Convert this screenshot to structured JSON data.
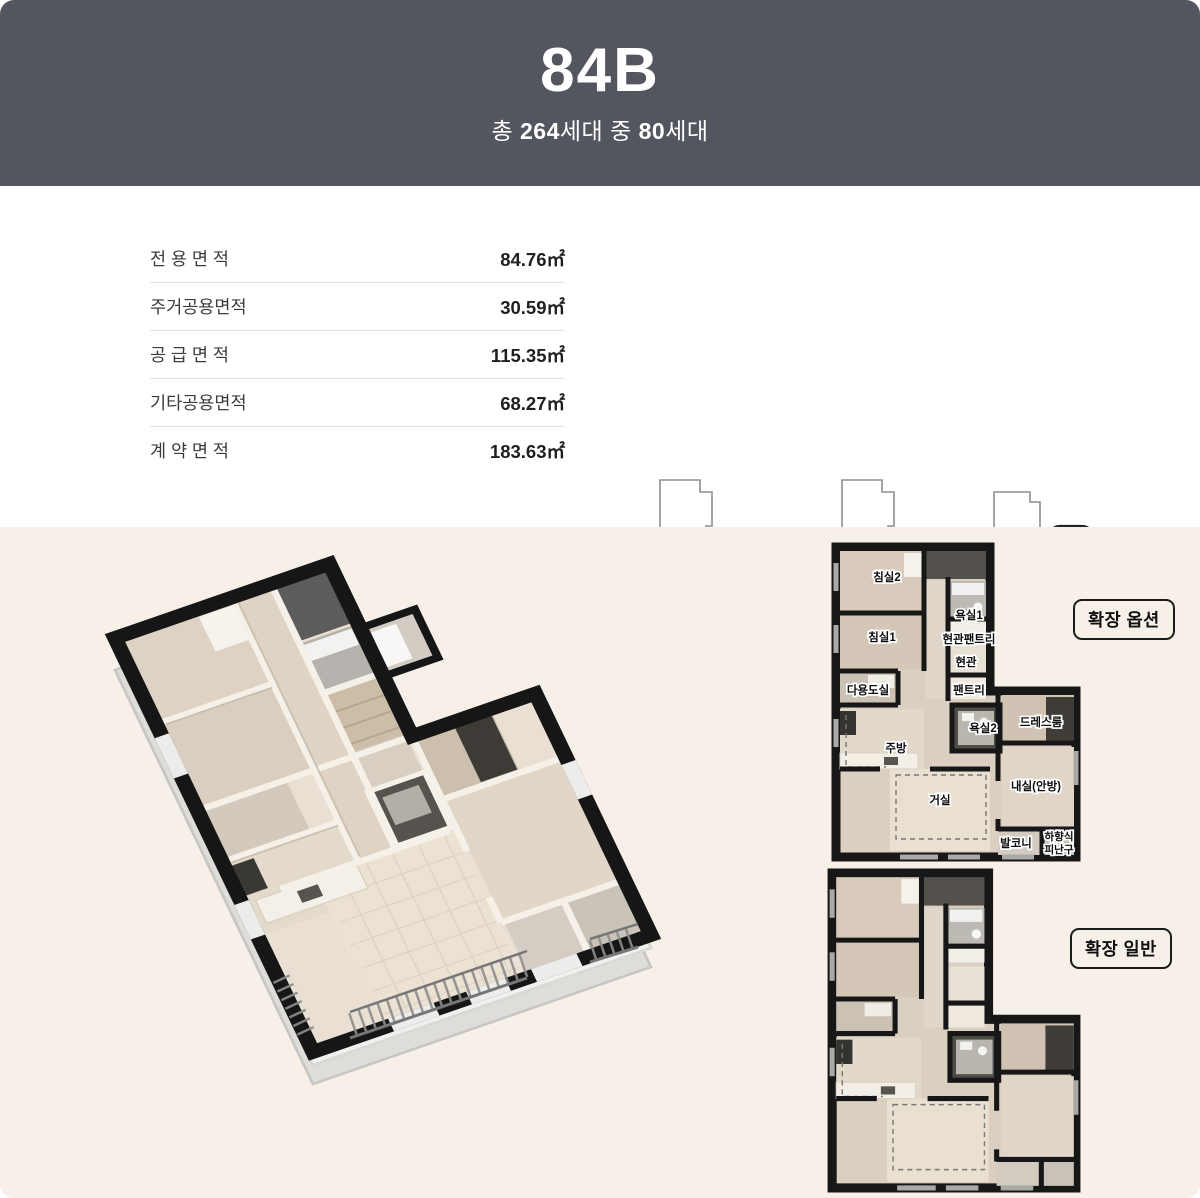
{
  "header": {
    "title": "84B",
    "subtitle": {
      "p1": "총 ",
      "b1": "264",
      "p2": "세대 중 ",
      "b2": "80",
      "p3": "세대"
    }
  },
  "area_table": {
    "rows": [
      {
        "label": "전 용 면 적",
        "value": "84.76㎡"
      },
      {
        "label": "주거공용면적",
        "value": "30.59㎡"
      },
      {
        "label": "공 급 면 적",
        "value": "115.35㎡"
      },
      {
        "label": "기타공용면적",
        "value": "68.27㎡"
      },
      {
        "label": "계 약 면 적",
        "value": "183.63㎡"
      }
    ]
  },
  "unit_diagrams": [
    {
      "id": "101"
    },
    {
      "id": "102"
    },
    {
      "id": "103"
    }
  ],
  "plans": {
    "option_badge": "확장 옵션",
    "general_badge": "확장 일반",
    "labels": {
      "bedroom2": "침실2",
      "bedroom1": "침실1",
      "bath1": "욕실1",
      "entry_pantry": "현관팬트리",
      "entry": "현관",
      "utility": "다용도실",
      "pantry": "팬트리",
      "bath2": "욕실2",
      "dressroom": "드레스룸",
      "kitchen": "주방",
      "living": "거실",
      "master": "내실(안방)",
      "balcony": "발코니",
      "hatch_line1": "하향식",
      "hatch_line2": "피난구"
    }
  },
  "colors": {
    "header_bg": "#53565f",
    "section_bg": "#f7f0e9",
    "unit_highlight": "#8e8ec7",
    "wall": "#171717"
  }
}
